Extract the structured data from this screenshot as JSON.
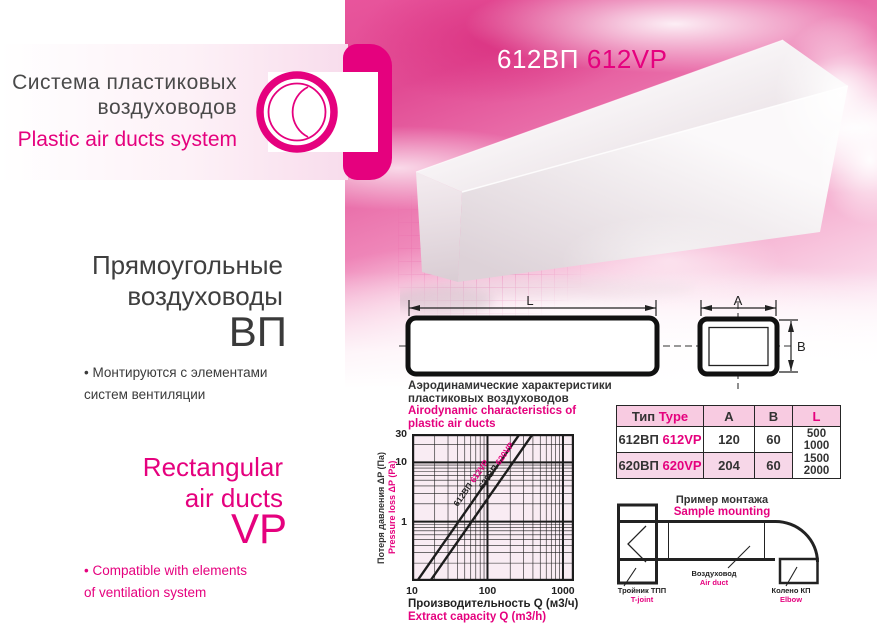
{
  "brand": {
    "title_ru_line1": "Система пластиковых",
    "title_ru_line2": "воздуховодов",
    "title_en": "Plastic air ducts system"
  },
  "product": {
    "code_ru": "612ВП",
    "code_en": "612VP"
  },
  "left_panel": {
    "ru": {
      "heading_line1": "Прямоугольные",
      "heading_line2": "воздуховоды",
      "code": "ВП",
      "bullet_line1": "Монтируются с элементами",
      "bullet_line2": "систем вентиляции"
    },
    "en": {
      "heading_line1": "Rectangular",
      "heading_line2": "air ducts",
      "code": "VP",
      "bullet_line1": "Compatible with elements",
      "bullet_line2": "of ventilation system"
    }
  },
  "drawing": {
    "dim_length": "L",
    "dim_width": "A",
    "dim_height": "B"
  },
  "chart_data": {
    "type": "line",
    "title_ru": [
      "Аэродинамические характеристики",
      "пластиковых воздуховодов"
    ],
    "title_en": [
      "Airodynamic characteristics of",
      "plastic air ducts"
    ],
    "xlabel_ru": "Производительность Q (м3/ч)",
    "xlabel_en": "Extract capacity Q (m3/h)",
    "ylabel_ru": "Потеря давления ΔP (Па)",
    "ylabel_en": "Pressure loss ΔP (Pa)",
    "x_scale": "log",
    "y_scale": "log",
    "xlim": [
      10,
      1400
    ],
    "ylim": [
      0.1,
      30
    ],
    "x_ticks": [
      10,
      100,
      1000
    ],
    "y_ticks": [
      30,
      10,
      1
    ],
    "grid": "log minor + major",
    "series": [
      {
        "name_ru": "612ВП",
        "name_en": "612VP",
        "points": [
          [
            11.7,
            0.1
          ],
          [
            267,
            30
          ]
        ]
      },
      {
        "name_ru": "620ВП",
        "name_en": "620VP",
        "points": [
          [
            17.4,
            0.1
          ],
          [
            398,
            30
          ]
        ]
      }
    ]
  },
  "table": {
    "header": {
      "type_ru": "Тип",
      "type_en": "Type",
      "col_a": "A",
      "col_b": "B",
      "col_l": "L"
    },
    "rows": [
      {
        "type_ru": "612ВП",
        "type_en": "612VP",
        "a": "120",
        "b": "60"
      },
      {
        "type_ru": "620ВП",
        "type_en": "620VP",
        "a": "204",
        "b": "60"
      }
    ],
    "l_values": [
      "500",
      "1000",
      "1500",
      "2000"
    ]
  },
  "mounting": {
    "title_ru": "Пример монтажа",
    "title_en": "Sample mounting",
    "labels": {
      "tjoint_ru": "Тройник ТПП",
      "tjoint_en": "T-joint",
      "duct_ru": "Воздуховод",
      "duct_en": "Air duct",
      "elbow_ru": "Колено КП",
      "elbow_en": "Elbow"
    }
  },
  "colors": {
    "accent": "#e5017e",
    "dark": "#3c3c3c",
    "table_header_bg": "#f8cbe1",
    "table_row_alt_bg": "#f7d7e8",
    "chart_bg": "#f9ecf3"
  }
}
